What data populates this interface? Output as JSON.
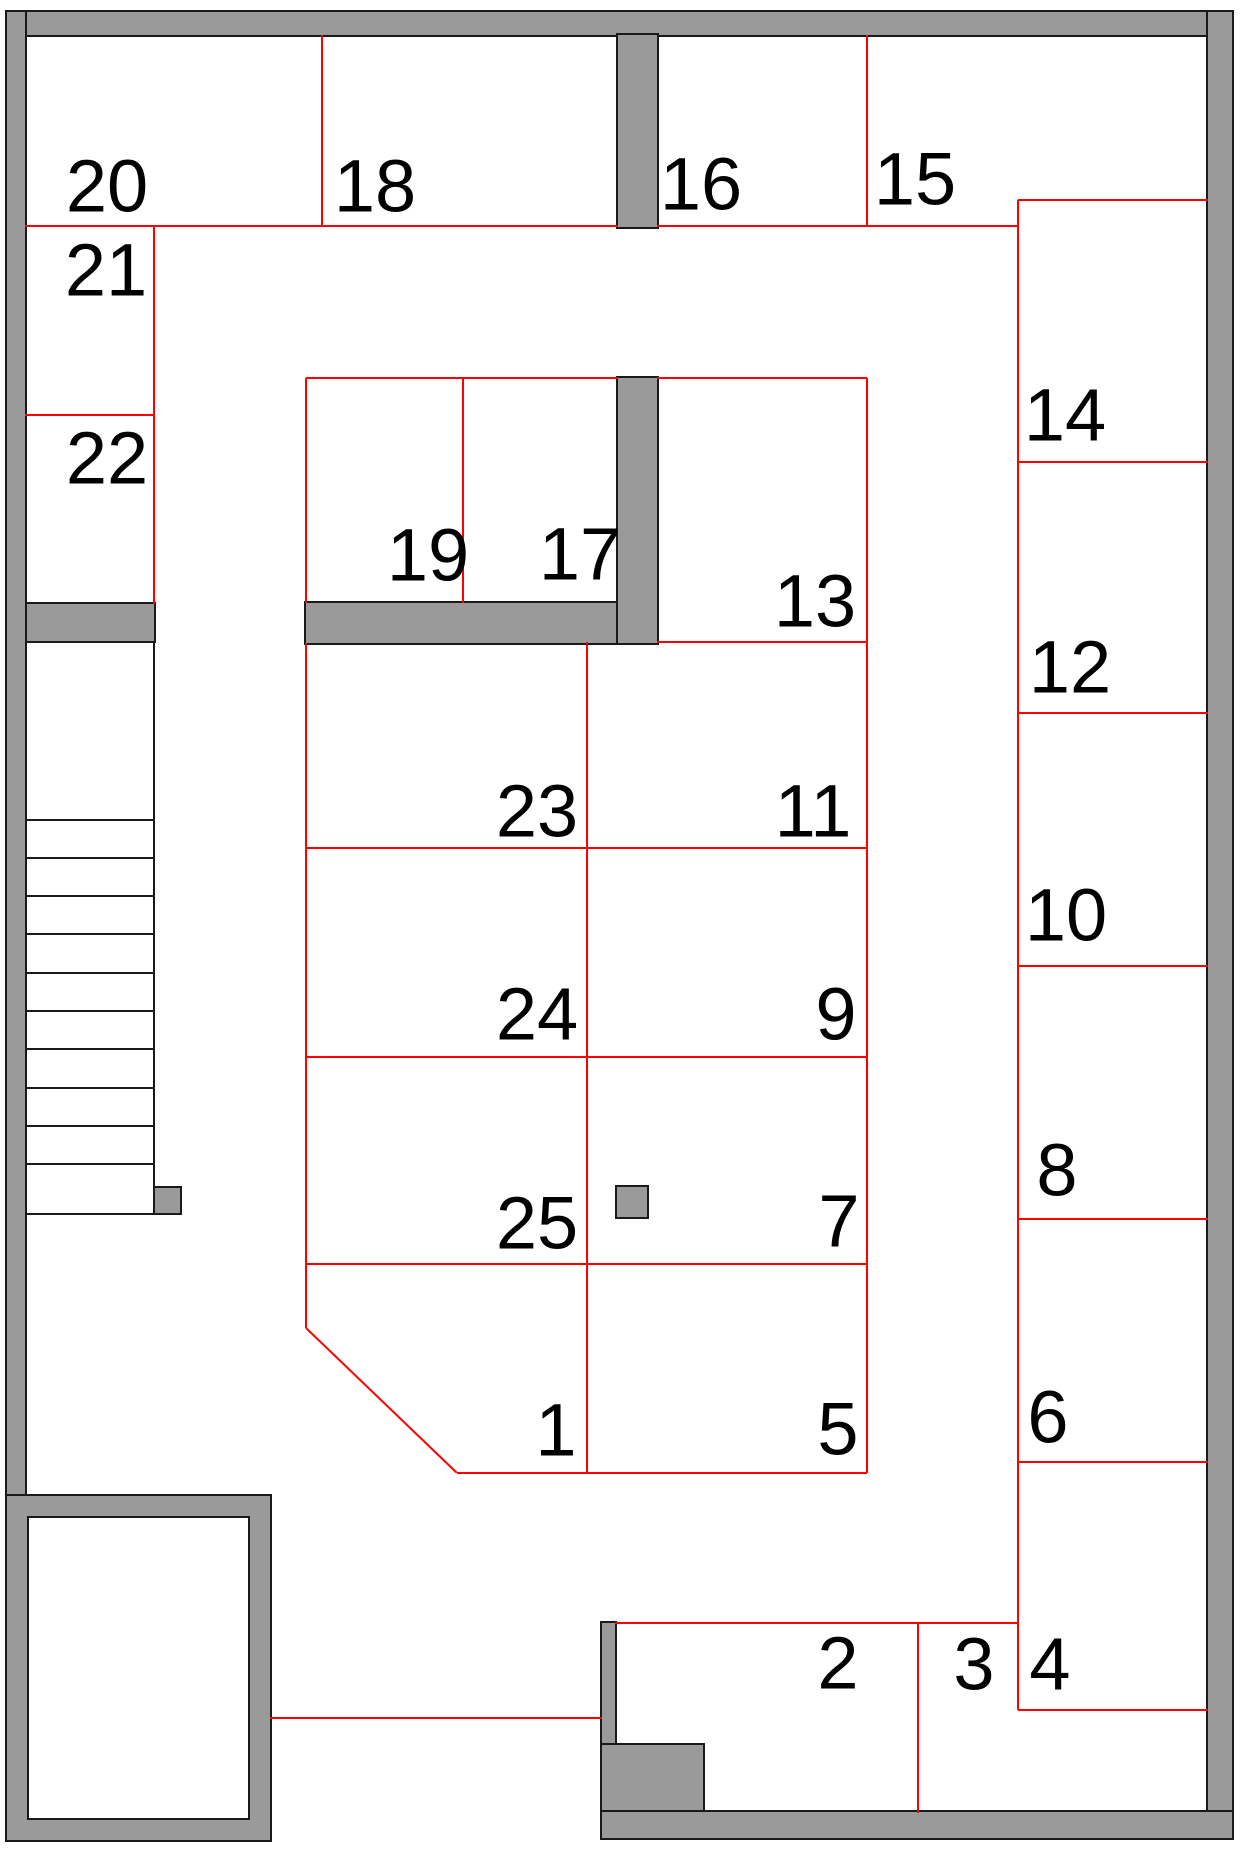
{
  "canvas": {
    "width": 1247,
    "height": 1853
  },
  "colors": {
    "wall_fill": "#9a9a9a",
    "wall_outline": "#1a1a1a",
    "partition_line": "#ff0000",
    "background": "#ffffff",
    "label_text": "#000000"
  },
  "rooms": [
    {
      "label": "20",
      "cx": 107,
      "cy": 188
    },
    {
      "label": "18",
      "cx": 375,
      "cy": 188
    },
    {
      "label": "16",
      "cx": 701,
      "cy": 186
    },
    {
      "label": "15",
      "cx": 915,
      "cy": 181
    },
    {
      "label": "21",
      "cx": 106,
      "cy": 272
    },
    {
      "label": "22",
      "cx": 107,
      "cy": 460
    },
    {
      "label": "19",
      "cx": 428,
      "cy": 557
    },
    {
      "label": "17",
      "cx": 580,
      "cy": 556
    },
    {
      "label": "13",
      "cx": 815,
      "cy": 603
    },
    {
      "label": "14",
      "cx": 1065,
      "cy": 417
    },
    {
      "label": "12",
      "cx": 1070,
      "cy": 669
    },
    {
      "label": "23",
      "cx": 537,
      "cy": 813
    },
    {
      "label": "11",
      "cx": 813,
      "cy": 813
    },
    {
      "label": "10",
      "cx": 1066,
      "cy": 917
    },
    {
      "label": "24",
      "cx": 537,
      "cy": 1016
    },
    {
      "label": "9",
      "cx": 836,
      "cy": 1016
    },
    {
      "label": "8",
      "cx": 1057,
      "cy": 1172
    },
    {
      "label": "25",
      "cx": 537,
      "cy": 1225
    },
    {
      "label": "7",
      "cx": 839,
      "cy": 1223
    },
    {
      "label": "6",
      "cx": 1048,
      "cy": 1419
    },
    {
      "label": "1",
      "cx": 556,
      "cy": 1432
    },
    {
      "label": "5",
      "cx": 838,
      "cy": 1431
    },
    {
      "label": "2",
      "cx": 838,
      "cy": 1665
    },
    {
      "label": "3",
      "cx": 974,
      "cy": 1666
    },
    {
      "label": "4",
      "cx": 1050,
      "cy": 1666
    }
  ],
  "walls": [
    {
      "name": "top-wall",
      "x": 5,
      "y": 10,
      "w": 1229,
      "h": 27
    },
    {
      "name": "left-wall",
      "x": 5,
      "y": 10,
      "w": 22,
      "h": 1832
    },
    {
      "name": "right-wall",
      "x": 1206,
      "y": 10,
      "w": 28,
      "h": 1830
    },
    {
      "name": "bottom-wall",
      "x": 600,
      "y": 1810,
      "w": 634,
      "h": 30
    },
    {
      "name": "pier-between-18-16",
      "x": 616,
      "y": 33,
      "w": 43,
      "h": 196
    },
    {
      "name": "wall-below-20-22",
      "x": 25,
      "y": 602,
      "w": 131,
      "h": 41
    },
    {
      "name": "wall-below-19-17",
      "x": 304,
      "y": 601,
      "w": 355,
      "h": 44
    },
    {
      "name": "wall-right-of-17",
      "x": 616,
      "y": 376,
      "w": 43,
      "h": 269
    },
    {
      "name": "bottom-center-pier",
      "x": 600,
      "y": 1621,
      "w": 17,
      "h": 191
    },
    {
      "name": "bottom-center-step",
      "x": 600,
      "y": 1743,
      "w": 105,
      "h": 69
    }
  ],
  "shaft_room": {
    "name": "bottom-left-shaft",
    "outer": {
      "x": 5,
      "y": 1494,
      "w": 267,
      "h": 348
    },
    "wall_thickness": 22
  },
  "staircase": {
    "box": {
      "x": 25,
      "y": 641,
      "w": 130,
      "h": 574
    },
    "tread_ys": [
      817,
      855,
      893,
      931,
      970,
      1008,
      1046,
      1085,
      1123,
      1161
    ]
  },
  "markers": [
    {
      "name": "stair-base-block",
      "x": 153,
      "y": 1186,
      "w": 29,
      "h": 29
    },
    {
      "name": "column-block",
      "x": 615,
      "y": 1185,
      "w": 34,
      "h": 34
    }
  ],
  "partitions": [
    {
      "x1": 25,
      "y1": 226,
      "x2": 618,
      "y2": 226
    },
    {
      "x1": 657,
      "y1": 226,
      "x2": 1018,
      "y2": 226
    },
    {
      "x1": 1018,
      "y1": 200,
      "x2": 1208,
      "y2": 200
    },
    {
      "x1": 25,
      "y1": 415,
      "x2": 154,
      "y2": 415
    },
    {
      "x1": 306,
      "y1": 378,
      "x2": 618,
      "y2": 378
    },
    {
      "x1": 657,
      "y1": 378,
      "x2": 867,
      "y2": 378
    },
    {
      "x1": 657,
      "y1": 642,
      "x2": 867,
      "y2": 642
    },
    {
      "x1": 306,
      "y1": 848,
      "x2": 867,
      "y2": 848
    },
    {
      "x1": 306,
      "y1": 1057,
      "x2": 867,
      "y2": 1057
    },
    {
      "x1": 306,
      "y1": 1264,
      "x2": 867,
      "y2": 1264
    },
    {
      "x1": 457,
      "y1": 1473,
      "x2": 867,
      "y2": 1473
    },
    {
      "x1": 1018,
      "y1": 462,
      "x2": 1208,
      "y2": 462
    },
    {
      "x1": 1018,
      "y1": 713,
      "x2": 1208,
      "y2": 713
    },
    {
      "x1": 1018,
      "y1": 966,
      "x2": 1208,
      "y2": 966
    },
    {
      "x1": 1018,
      "y1": 1219,
      "x2": 1208,
      "y2": 1219
    },
    {
      "x1": 1018,
      "y1": 1462,
      "x2": 1208,
      "y2": 1462
    },
    {
      "x1": 1018,
      "y1": 1710,
      "x2": 1208,
      "y2": 1710
    },
    {
      "x1": 615,
      "y1": 1623,
      "x2": 1018,
      "y2": 1623
    },
    {
      "x1": 270,
      "y1": 1718,
      "x2": 602,
      "y2": 1718
    },
    {
      "x1": 322,
      "y1": 35,
      "x2": 322,
      "y2": 226
    },
    {
      "x1": 154,
      "y1": 226,
      "x2": 154,
      "y2": 604
    },
    {
      "x1": 867,
      "y1": 35,
      "x2": 867,
      "y2": 226
    },
    {
      "x1": 306,
      "y1": 378,
      "x2": 306,
      "y2": 603
    },
    {
      "x1": 463,
      "y1": 378,
      "x2": 463,
      "y2": 603
    },
    {
      "x1": 867,
      "y1": 378,
      "x2": 867,
      "y2": 1473
    },
    {
      "x1": 587,
      "y1": 642,
      "x2": 587,
      "y2": 1473
    },
    {
      "x1": 306,
      "y1": 643,
      "x2": 306,
      "y2": 1328
    },
    {
      "x1": 1018,
      "y1": 200,
      "x2": 1018,
      "y2": 1710
    },
    {
      "x1": 918,
      "y1": 1623,
      "x2": 918,
      "y2": 1813
    },
    {
      "x1": 306,
      "y1": 1328,
      "x2": 457,
      "y2": 1473
    }
  ]
}
